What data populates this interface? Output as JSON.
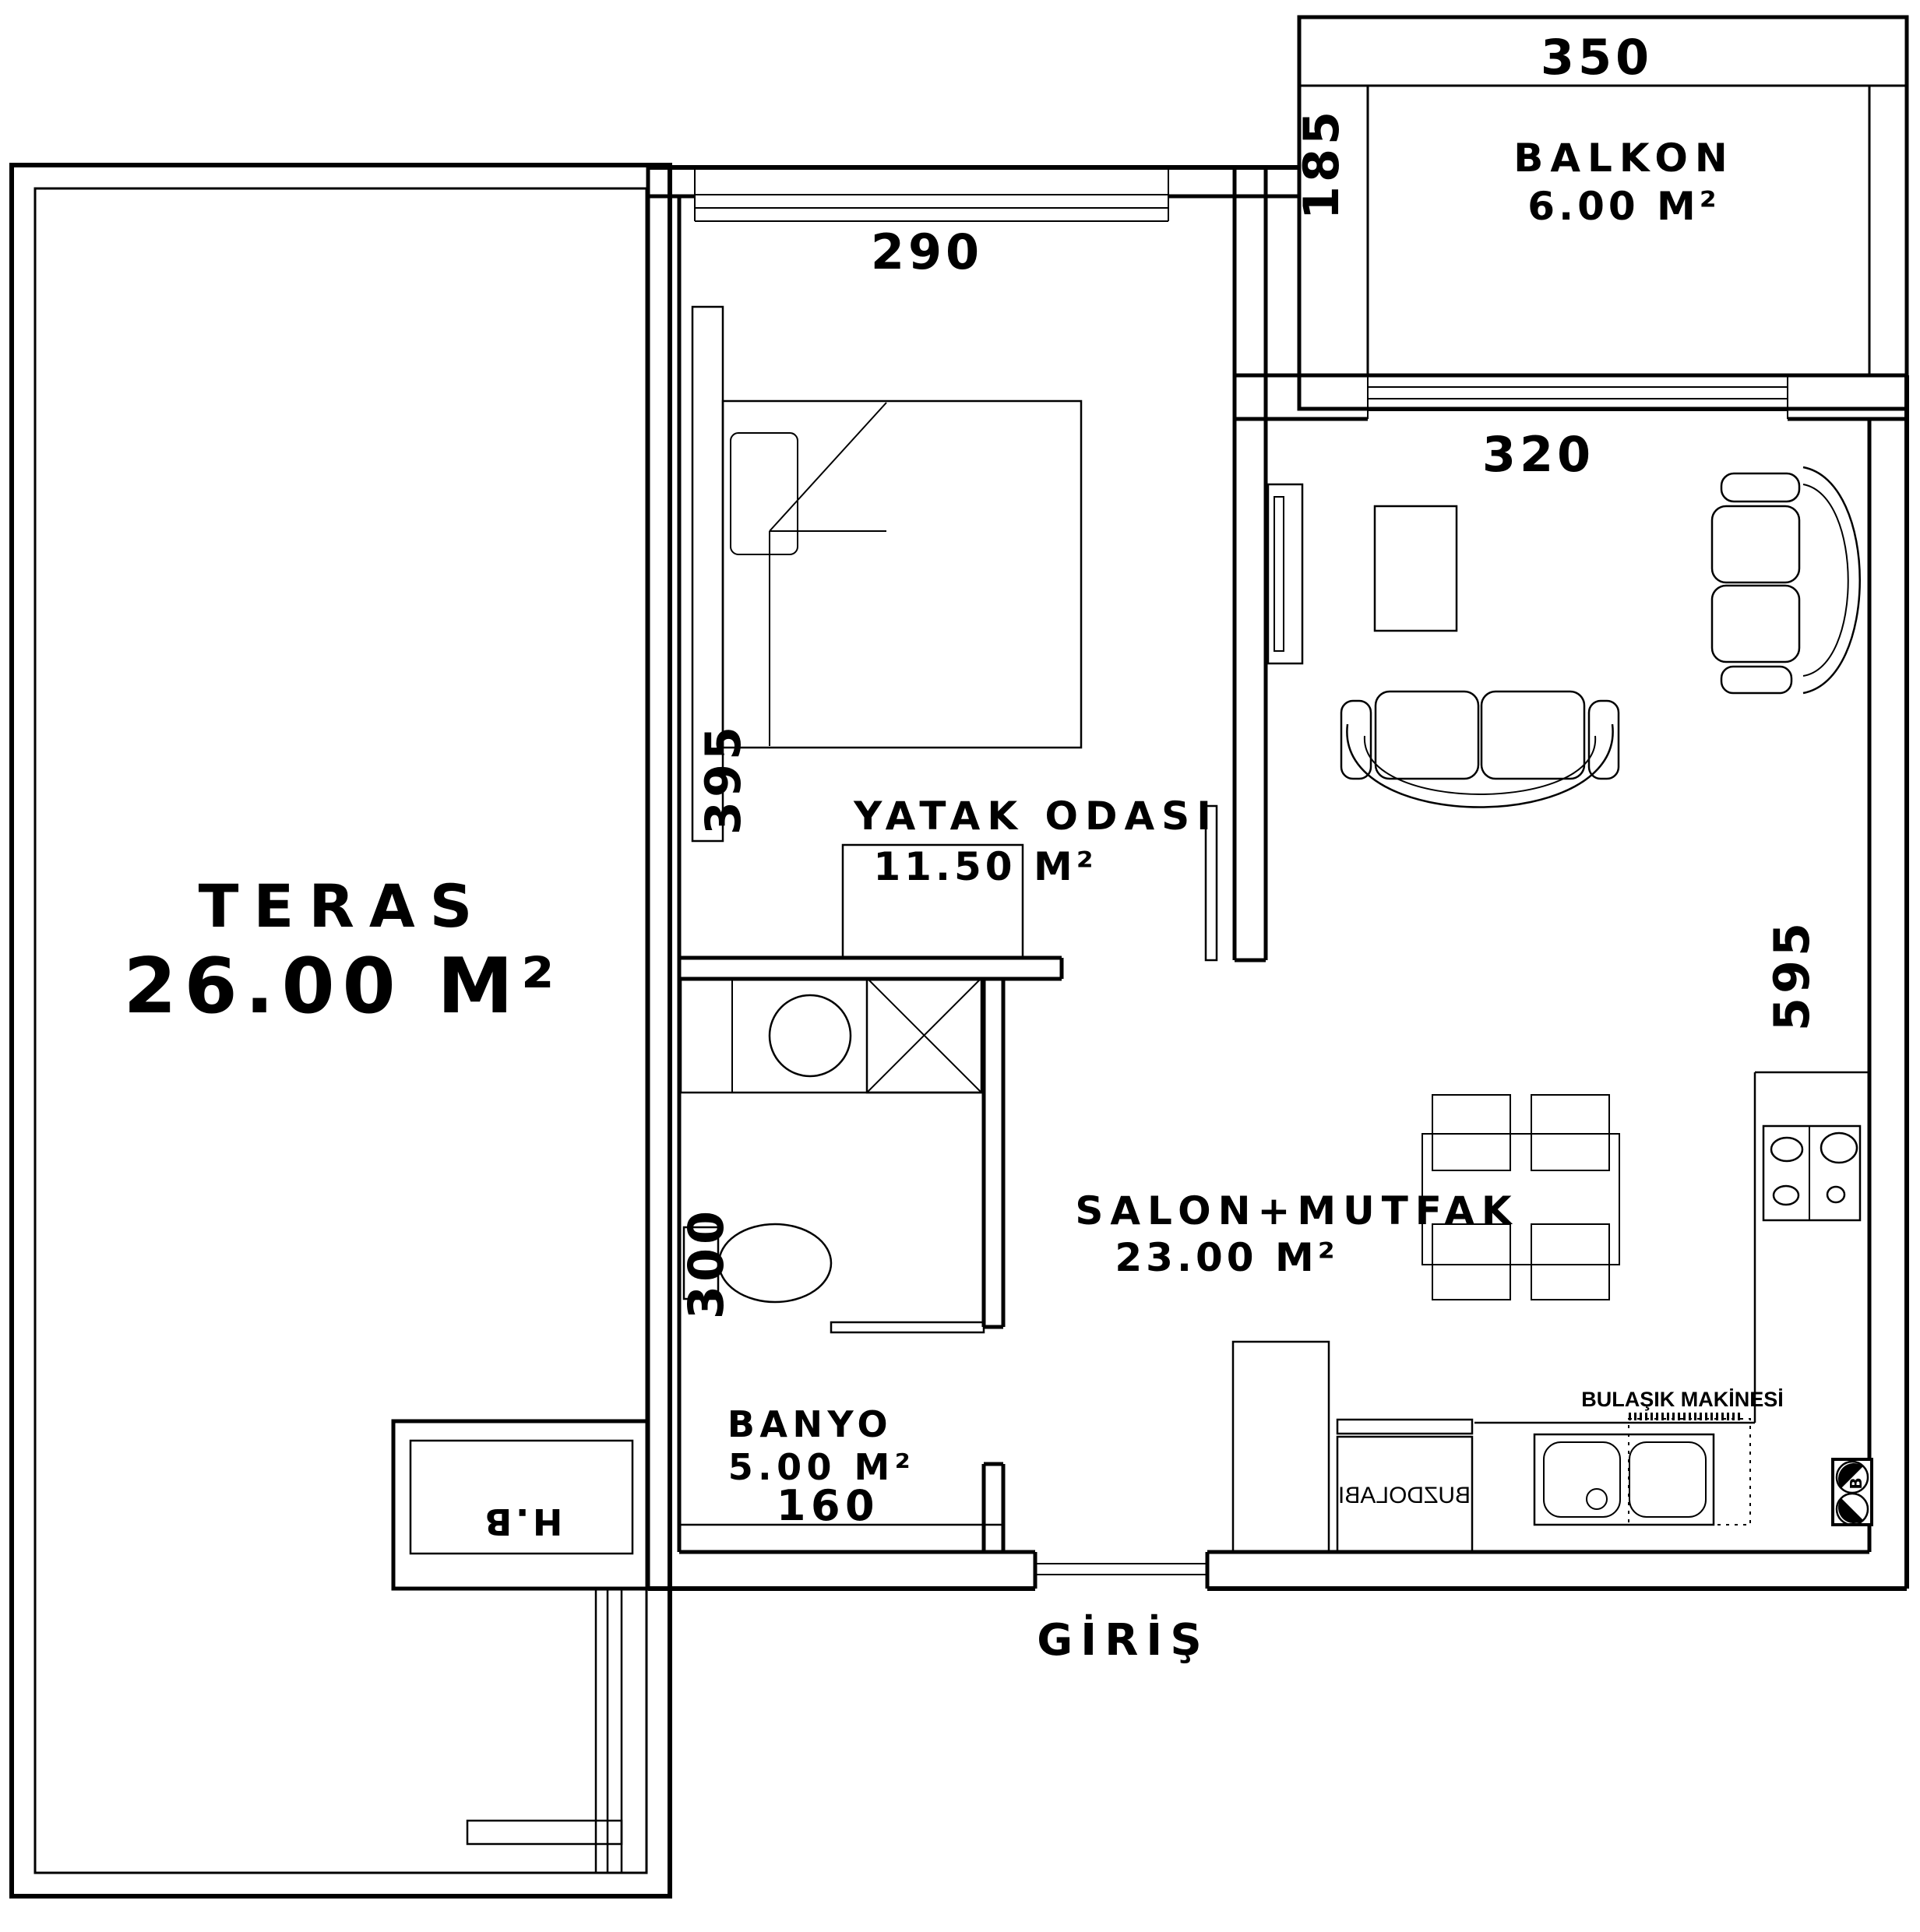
{
  "plan": {
    "rooms": {
      "teras": {
        "name": "TERAS",
        "area": "26.00 M²"
      },
      "yatak": {
        "name": "YATAK ODASI",
        "area": "11.50 M²"
      },
      "balkon": {
        "name": "BALKON",
        "area": "6.00 M²"
      },
      "salon": {
        "name": "SALON+MUTFAK",
        "area": "23.00 M²"
      },
      "banyo": {
        "name": "BANYO",
        "area": "5.00 M²"
      }
    },
    "dims": {
      "balcony_w": "350",
      "balcony_d": "185",
      "bedroom_w": "290",
      "bedroom_d": "395",
      "salon_w": "320",
      "salon_d": "595",
      "bath_d": "300",
      "bath_w": "160"
    },
    "labels": {
      "entrance": "GİRİŞ",
      "shaft": "H.B",
      "dishwasher": "BULAŞIK MAKİNESİ",
      "fridge": "BUZDOLABI",
      "electric": "B"
    }
  }
}
